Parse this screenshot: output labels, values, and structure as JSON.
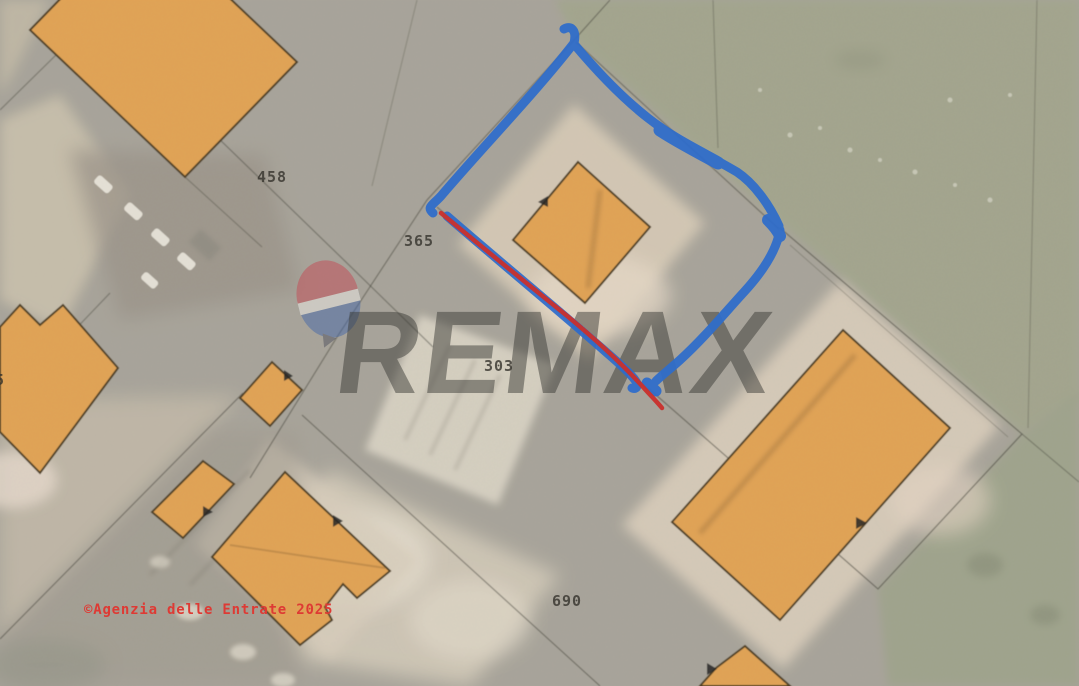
{
  "map": {
    "kind": "cadastral-parcel-overlay-on-satellite",
    "watermark": {
      "brand": "REMAX"
    },
    "copyright_notice": "©Agenzia delle Entrate 2025",
    "parcel_labels": [
      {
        "number": "458"
      },
      {
        "number": "365"
      },
      {
        "number": "303"
      },
      {
        "number": "690"
      },
      {
        "number": "5"
      }
    ],
    "annotations": {
      "highlighted_parcel_outline_color": "#2E6CCB",
      "secondary_line_color": "#C9302C"
    },
    "colors": {
      "building_fill": "#E3A251",
      "building_stroke": "#4A3A1E",
      "field_green": "#A2A58C",
      "ground_gray": "#A7A399",
      "copyright_red": "#DE3A34",
      "label_ink": "#34322C"
    }
  }
}
